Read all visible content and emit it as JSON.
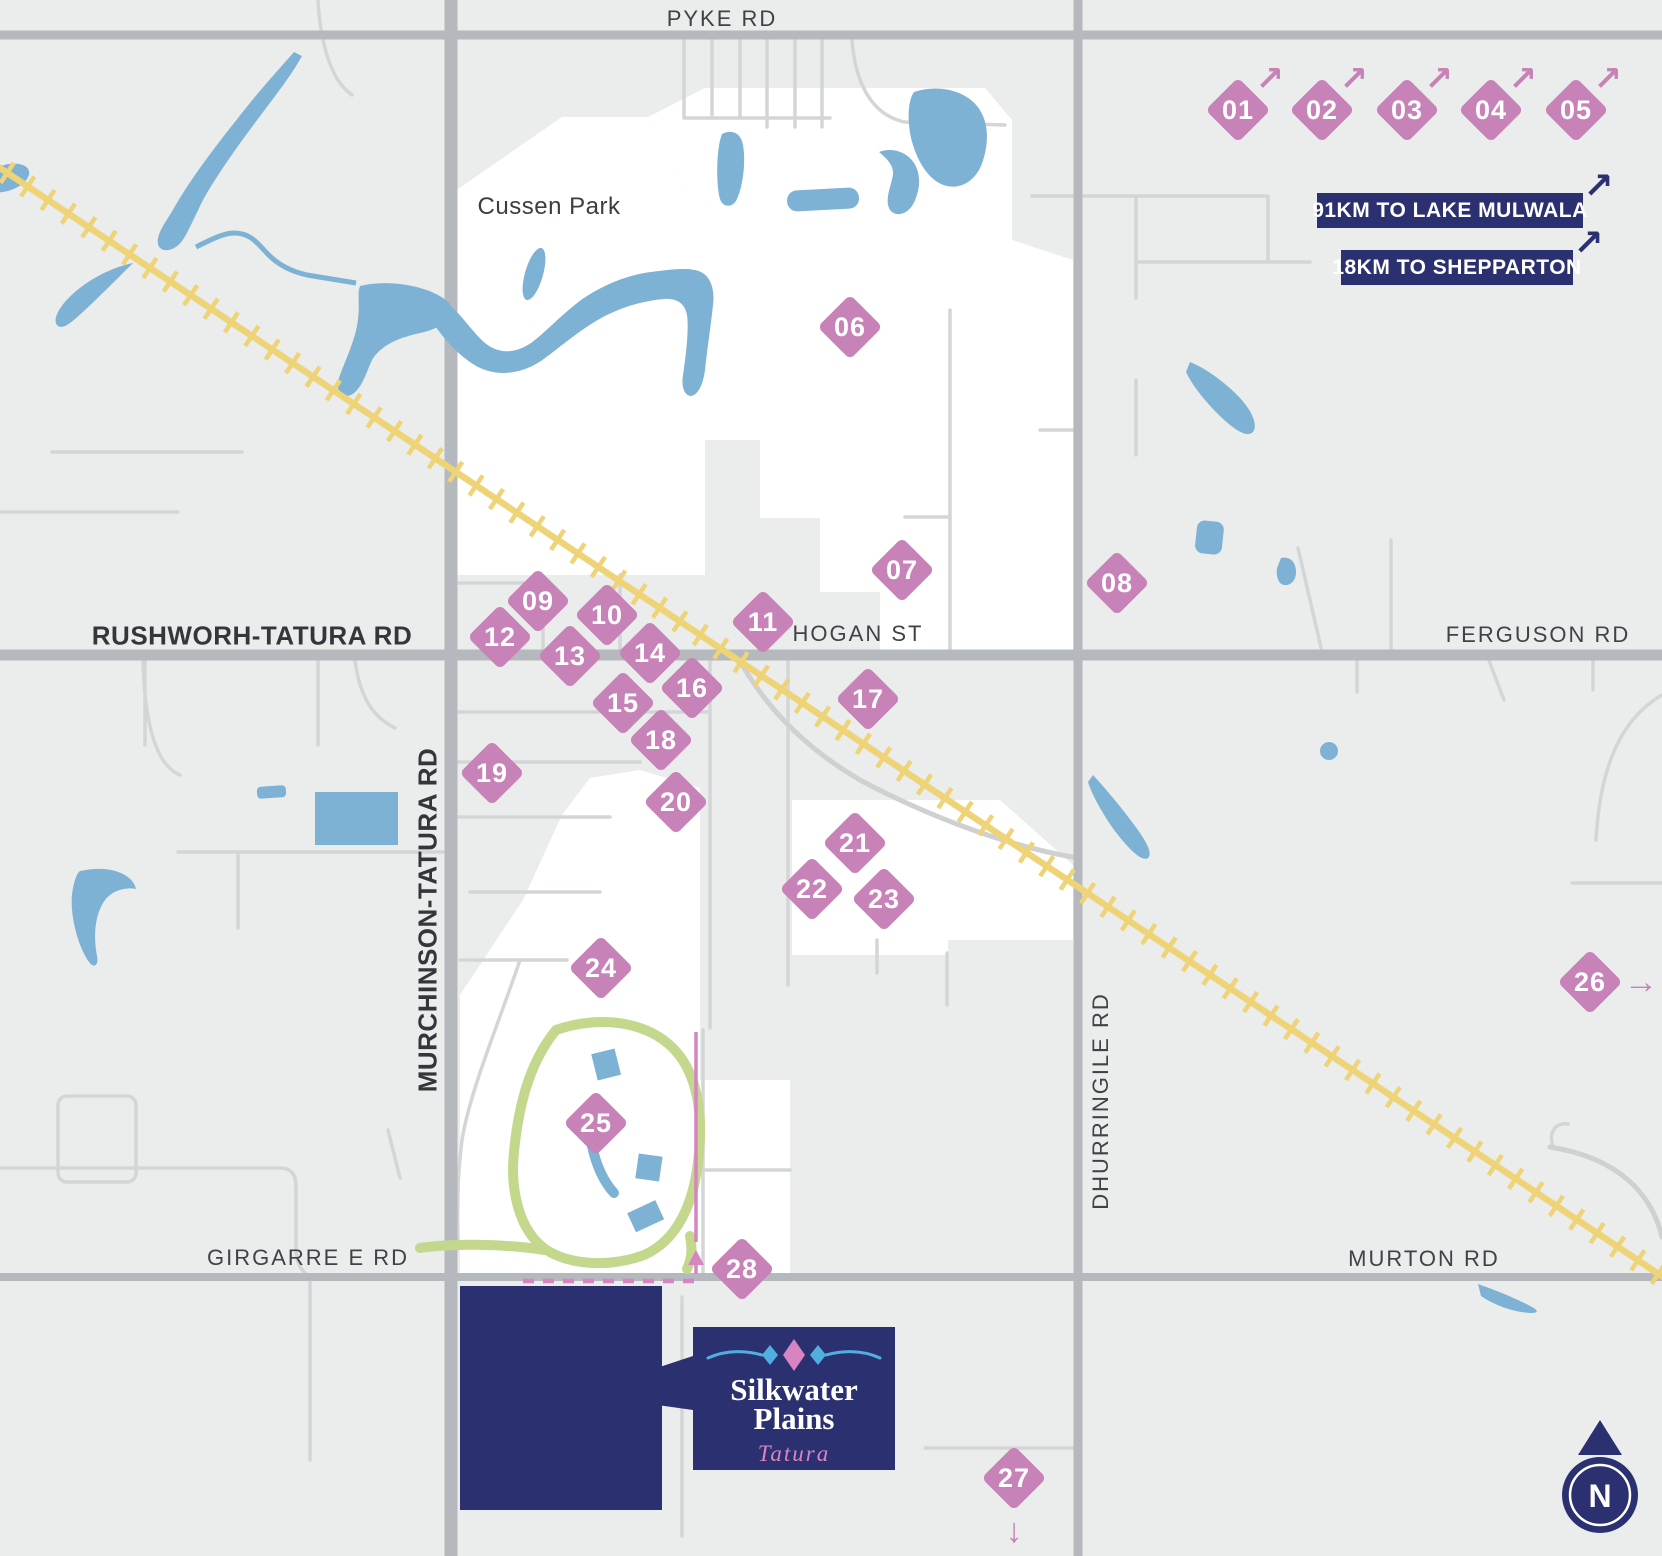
{
  "colors": {
    "marker_pink": "#c783b8",
    "navy": "#2b3170",
    "water": "#7eb2d4",
    "railway": "#eed377",
    "race_green": "#c3d88d",
    "boundary_pink": "#d884c1",
    "flourish_blue": "#4fb0e0"
  },
  "road_labels": [
    {
      "id": "pyke-rd",
      "text": "PYKE RD",
      "x": 722,
      "y": 19
    },
    {
      "id": "cussen-park",
      "text": "Cussen Park",
      "x": 549,
      "y": 207,
      "park": true
    },
    {
      "id": "rushworh-tatura-rd",
      "text": "RUSHWORH-TATURA RD",
      "x": 252,
      "y": 636,
      "bold": true
    },
    {
      "id": "hogan-st",
      "text": "HOGAN ST",
      "x": 858,
      "y": 634
    },
    {
      "id": "ferguson-rd",
      "text": "FERGUSON RD",
      "x": 1538,
      "y": 635
    },
    {
      "id": "murchinson-tatura-rd",
      "text": "MURCHINSON-TATURA RD",
      "x": 428,
      "y": 920,
      "bold": true,
      "vertical": true
    },
    {
      "id": "dhurringile-rd",
      "text": "DHURRINGILE RD",
      "x": 1101,
      "y": 1101,
      "vertical": true
    },
    {
      "id": "girgarre-e-rd",
      "text": "GIRGARRE E RD",
      "x": 308,
      "y": 1258
    },
    {
      "id": "murton-rd",
      "text": "MURTON RD",
      "x": 1424,
      "y": 1259
    }
  ],
  "distance_badges": [
    {
      "text": "91KM TO LAKE MULWALA",
      "x": 1317,
      "y": 193,
      "w": 266,
      "h": 35
    },
    {
      "text": "18KM TO SHEPPARTON",
      "x": 1341,
      "y": 250,
      "w": 232,
      "h": 35
    }
  ],
  "arrow_glyphs": {
    "ne": "↗",
    "e": "→",
    "s": "↓"
  },
  "markers": [
    {
      "num": "01",
      "x": 1238,
      "y": 110,
      "arrow": "ne"
    },
    {
      "num": "02",
      "x": 1322,
      "y": 110,
      "arrow": "ne"
    },
    {
      "num": "03",
      "x": 1407,
      "y": 110,
      "arrow": "ne"
    },
    {
      "num": "04",
      "x": 1491,
      "y": 110,
      "arrow": "ne"
    },
    {
      "num": "05",
      "x": 1576,
      "y": 110,
      "arrow": "ne"
    },
    {
      "num": "06",
      "x": 850,
      "y": 327
    },
    {
      "num": "07",
      "x": 902,
      "y": 570
    },
    {
      "num": "08",
      "x": 1117,
      "y": 583
    },
    {
      "num": "09",
      "x": 538,
      "y": 601
    },
    {
      "num": "10",
      "x": 607,
      "y": 615
    },
    {
      "num": "11",
      "x": 763,
      "y": 622
    },
    {
      "num": "12",
      "x": 500,
      "y": 637
    },
    {
      "num": "13",
      "x": 570,
      "y": 656
    },
    {
      "num": "14",
      "x": 650,
      "y": 653
    },
    {
      "num": "15",
      "x": 623,
      "y": 703
    },
    {
      "num": "16",
      "x": 692,
      "y": 688
    },
    {
      "num": "17",
      "x": 868,
      "y": 699
    },
    {
      "num": "18",
      "x": 661,
      "y": 740
    },
    {
      "num": "19",
      "x": 492,
      "y": 773
    },
    {
      "num": "20",
      "x": 676,
      "y": 802
    },
    {
      "num": "21",
      "x": 855,
      "y": 843
    },
    {
      "num": "22",
      "x": 812,
      "y": 889
    },
    {
      "num": "23",
      "x": 884,
      "y": 899
    },
    {
      "num": "24",
      "x": 601,
      "y": 968
    },
    {
      "num": "25",
      "x": 596,
      "y": 1123
    },
    {
      "num": "26",
      "x": 1590,
      "y": 982,
      "arrow": "e"
    },
    {
      "num": "27",
      "x": 1014,
      "y": 1478,
      "arrow": "s"
    },
    {
      "num": "28",
      "x": 742,
      "y": 1269
    }
  ],
  "logo": {
    "line1": "Silkwater",
    "line2": "Plains",
    "script": "Tatura"
  },
  "compass": {
    "label": "N"
  }
}
